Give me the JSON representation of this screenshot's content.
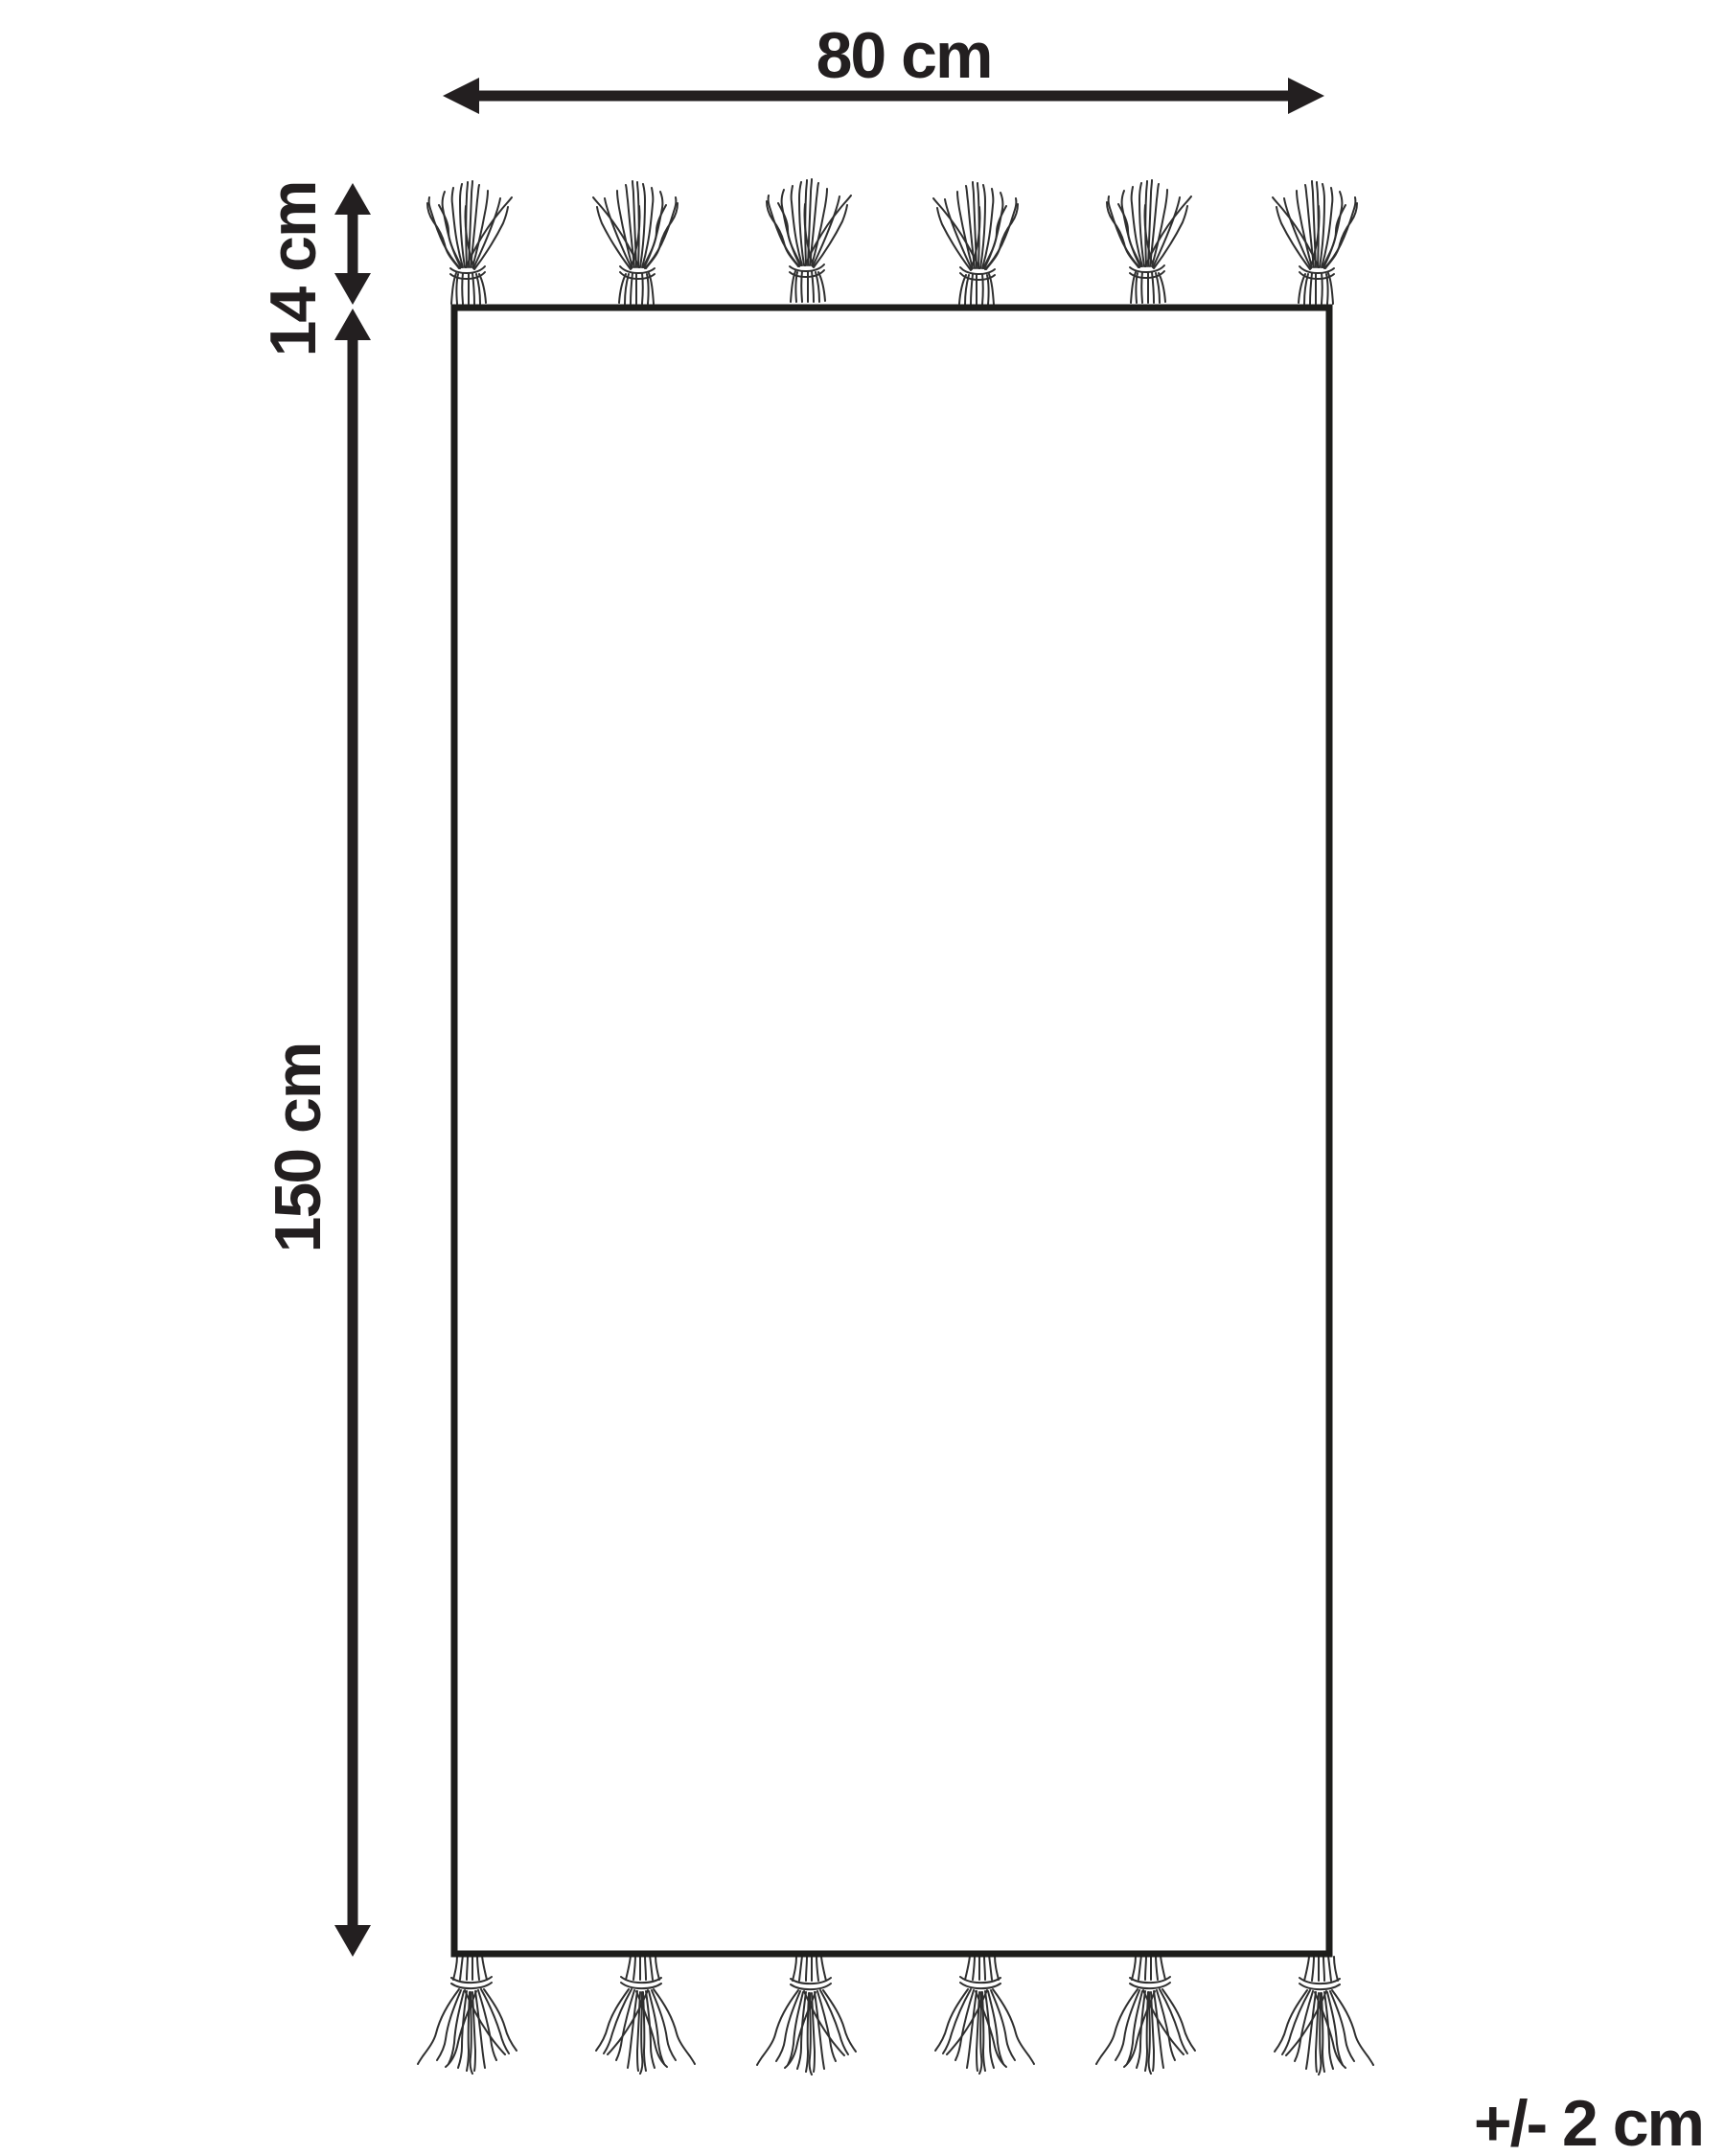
{
  "diagram": {
    "type": "rug-dimension-drawing",
    "labels": {
      "width": "80 cm",
      "fringe": "14 cm",
      "length": "150 cm",
      "tolerance": "+/- 2 cm"
    },
    "values": {
      "width_cm": 80,
      "fringe_cm": 14,
      "length_cm": 150,
      "tolerance_cm": 2
    },
    "colors": {
      "ink": "#231f20",
      "outline": "#1d1d1b",
      "strand": "#2f2f2f",
      "background": "#ffffff"
    },
    "icons": {
      "tassel": "tassel-icon",
      "width_arrow": "double-arrow-horizontal-icon",
      "fringe_arrow": "double-arrow-vertical-icon",
      "length_arrow": "double-arrow-vertical-icon"
    },
    "tassel_count_top": 6,
    "tassel_count_bottom": 6
  }
}
